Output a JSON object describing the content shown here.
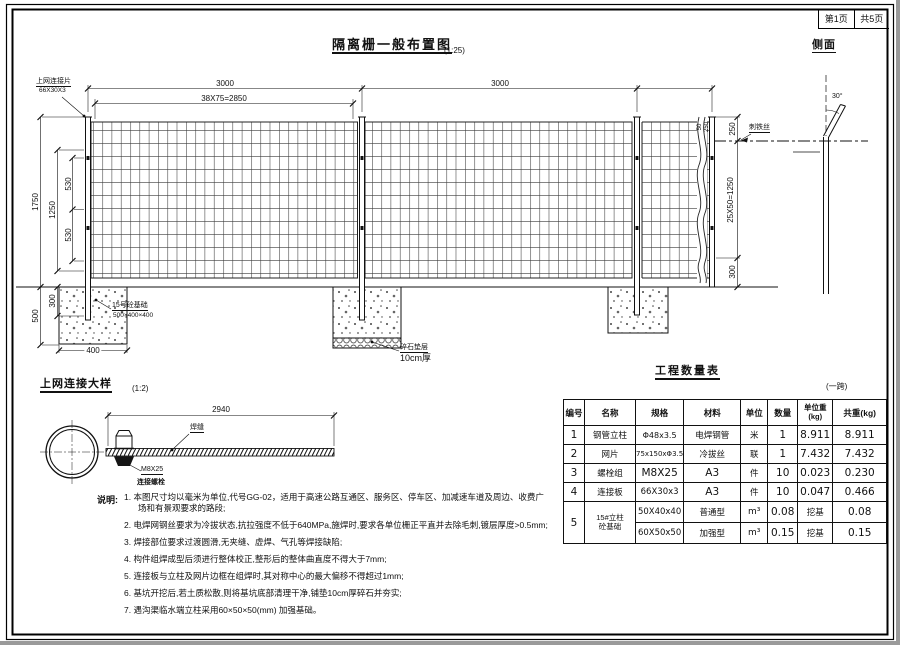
{
  "sheet": {
    "page_label": "第1页",
    "pages_label": "共5页"
  },
  "elevation": {
    "title": "隔离栅一般布置图",
    "scale": "(1:25)",
    "labels": {
      "top_connection_piece": "上网连接片",
      "top_connection_spec": "66X30X3",
      "barbed_wire": "刺铁丝",
      "footing_name": "15号砼基础",
      "footing_spec": "500×400×400",
      "cushion_name": "碎石垫层",
      "cushion_spec": "10cm厚"
    },
    "dims": {
      "span_left": "3000",
      "span_right": "3000",
      "mesh_pitch": "38X75=2850",
      "post_height": "1750",
      "mesh_height": "1250",
      "mesh_upper": "530",
      "mesh_lower": "530",
      "footing_depth": "500",
      "embed_depth": "300",
      "footing_width": "400",
      "right_top": "250",
      "right_small_a": "50",
      "right_small_b": "250",
      "right_mesh": "25X50=1250",
      "right_bottom": "300"
    }
  },
  "side_view": {
    "title": "侧面",
    "angle": "30°"
  },
  "detail": {
    "title": "上网连接大样",
    "scale": "(1:2)",
    "dim_length": "2940",
    "weld_label": "焊缝",
    "bolt_spec": "M8X25",
    "bolt_label": "连接螺栓"
  },
  "quantity_table": {
    "title": "工程数量表",
    "note": "(一跨)",
    "headers": [
      "编号",
      "名称",
      "规格",
      "材料",
      "单位",
      "数量"
    ],
    "header_unit_weight": "单位重",
    "header_unit_weight_sub": "(kg)",
    "header_total_weight": "共重(kg)",
    "rows": [
      [
        "1",
        "钢管立柱",
        "Φ48x3.5",
        "电焊钢管",
        "米",
        "1",
        "8.911",
        "8.911"
      ],
      [
        "2",
        "网片",
        "75x150xΦ3.5",
        "冷拔丝",
        "联",
        "1",
        "7.432",
        "7.432"
      ],
      [
        "3",
        "螺栓组",
        "M8X25",
        "A3",
        "件",
        "10",
        "0.023",
        "0.230"
      ],
      [
        "4",
        "连接板",
        "66X30x3",
        "A3",
        "件",
        "10",
        "0.047",
        "0.466"
      ]
    ],
    "row5": {
      "no": "5",
      "name_line1": "15#立柱",
      "name_line2": "砼基础",
      "sub_rows": [
        {
          "spec": "50X40x40",
          "material": "普通型",
          "unit": "m³",
          "qty": "0.08",
          "note": "挖基",
          "total": "0.08"
        },
        {
          "spec": "60X50x50",
          "material": "加强型",
          "unit": "m³",
          "qty": "0.15",
          "note": "挖基",
          "total": "0.15"
        }
      ]
    }
  },
  "notes": {
    "label": "说明:",
    "items": [
      "1. 本图尺寸均以毫米为单位,代号GG-02，适用于高速公路互通区、服务区、停车区、加减速车道及周边、收费广场和有景观要求的路段;",
      "2. 电焊网钢丝要求为冷拔状态,抗拉强度不低于640MPa,施焊时,要求各单位栅正平直并去除毛刺,镀层厚度>0.5mm;",
      "3. 焊接部位要求过渡圆滑,无夹缝、虚焊、气孔等焊接缺陷;",
      "4. 构件组焊成型后须进行整体校正,整形后的整体曲直度不得大于7mm;",
      "5. 连接板与立柱及网片边框在组焊时,其对称中心的最大偏移不得超过1mm;",
      "6. 基坑开挖后,若土质松散,则将基坑底部清理干净,铺垫10cm厚碎石并夯实;",
      "7. 遇沟渠临水端立柱采用60×50×50(mm) 加强基础。"
    ]
  }
}
